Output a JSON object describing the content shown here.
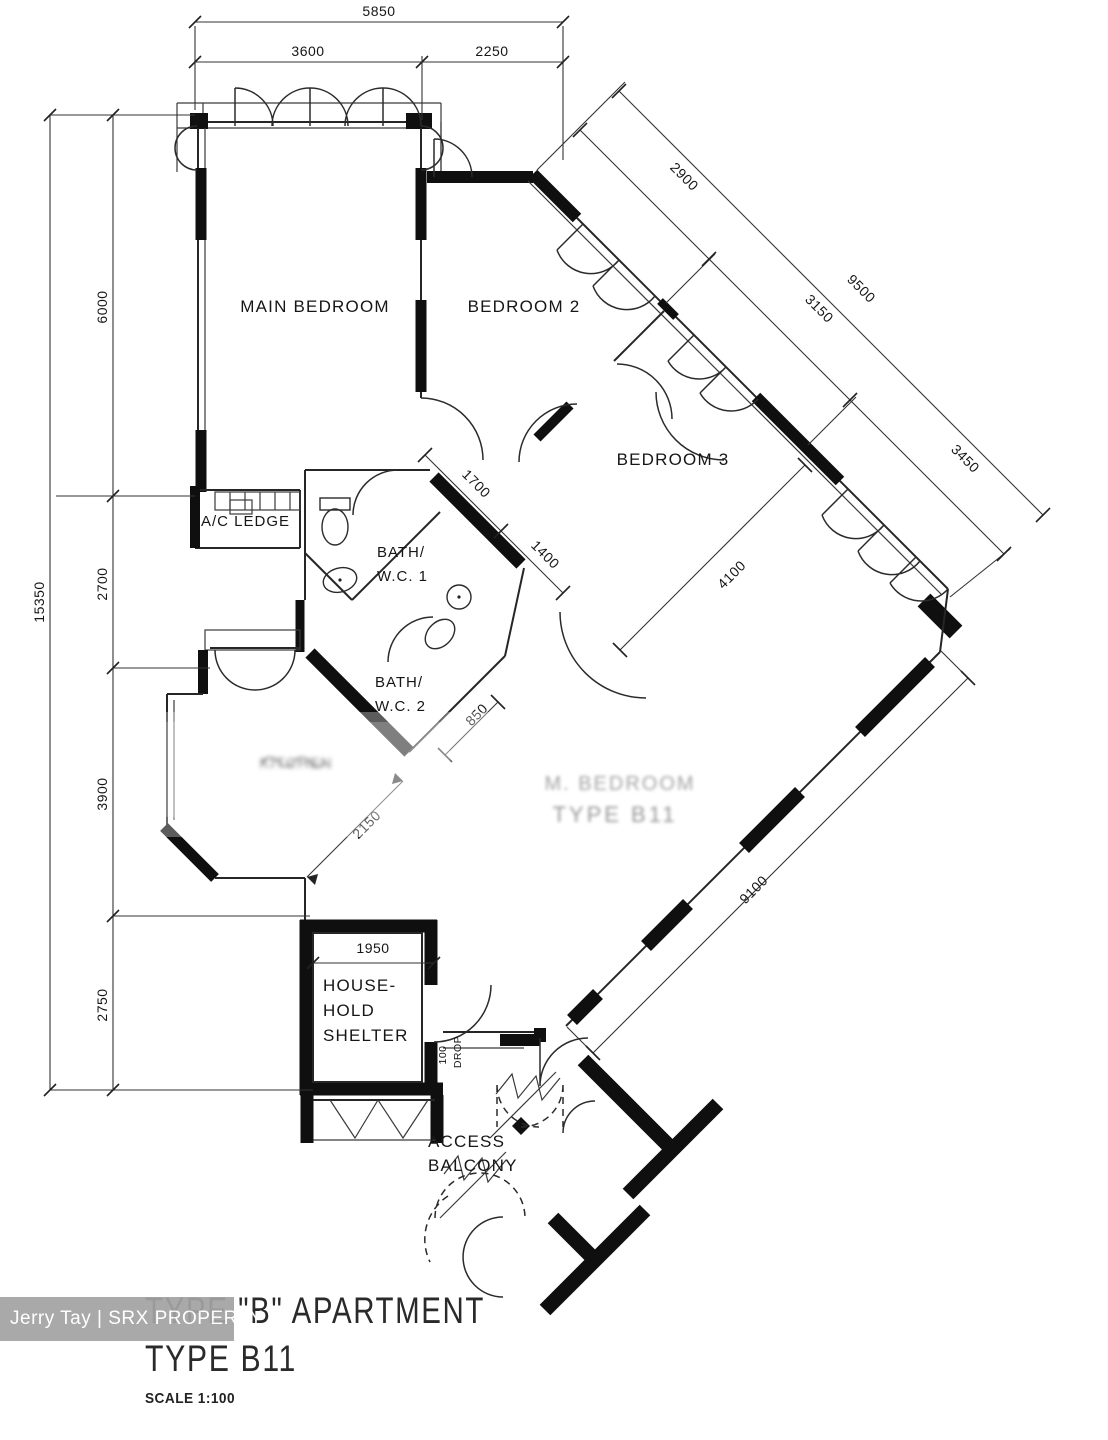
{
  "canvas": {
    "width": 1108,
    "height": 1440,
    "background": "#ffffff",
    "ink": "#1a1a1a"
  },
  "title": {
    "line1": "TYPE \"B\" APARTMENT",
    "line2": "TYPE B11",
    "scale_label": "SCALE 1:100"
  },
  "watermark": {
    "text": "Jerry Tay | SRX PROPERTY",
    "bg": "#a3a3a3",
    "fg": "#ffffff"
  },
  "rooms": {
    "main_bedroom": "MAIN BEDROOM",
    "bedroom_2": "BEDROOM 2",
    "bedroom_3": "BEDROOM 3",
    "bath_wc_1_line1": "BATH/",
    "bath_wc_1_line2": "W.C. 1",
    "bath_wc_2_line1": "BATH/",
    "bath_wc_2_line2": "W.C. 2",
    "ac_ledge": "A/C LEDGE",
    "household_shelter_line1": "HOUSE-",
    "household_shelter_line2": "HOLD",
    "household_shelter_line3": "SHELTER",
    "access_balcony_line1": "ACCESS",
    "access_balcony_line2": "BALCONY"
  },
  "dims": {
    "top_overall": "5850",
    "top_left": "3600",
    "top_right": "2250",
    "left_overall": "15350",
    "left_seg1": "6000",
    "left_seg2": "2700",
    "left_seg3": "3900",
    "left_seg4": "2750",
    "ne_seg1": "2900",
    "ne_seg2": "3150",
    "ne_overall": "9500",
    "ne_seg3": "3450",
    "bedroom3_width": "4100",
    "lobby_a": "1700",
    "lobby_b": "1400",
    "bath2_w": "850",
    "living_opening": "2150",
    "corridor": "9100",
    "shelter_w": "1950",
    "drop_value": "100",
    "drop_label": "DROP"
  },
  "faded": {
    "stamp_line1": "M. BEDROOM",
    "stamp_line2": "TYPE B11",
    "kitchen_label": "KITCHEN"
  }
}
